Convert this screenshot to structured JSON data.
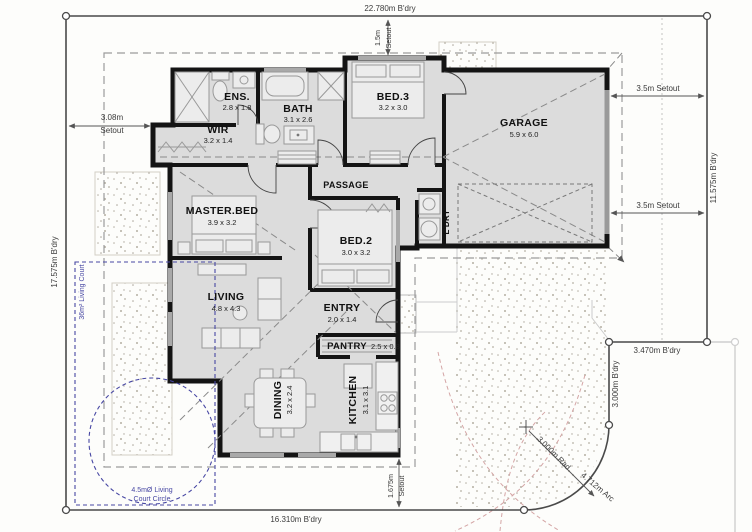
{
  "drawing": {
    "type": "residential floor plan / site plan"
  },
  "boundaries": {
    "top": "22.780m B'dry",
    "left": "17.575m B'dry",
    "right": "11.575m B'dry",
    "bottom": "16.310m B'dry",
    "corner_horizontal": "3.470m B'dry",
    "corner_vertical": "3.000m B'dry",
    "corner_radius": "3.000m Rad",
    "corner_arc": "4.712m Arc"
  },
  "setouts": {
    "north_value": "1.5m",
    "north_label": "Setout",
    "west_value": "3.08m",
    "west_label": "Setout",
    "east_top": "3.5m Setout",
    "east_bottom": "3.5m Setout",
    "south_value": "1.675m",
    "south_label": "Setout"
  },
  "living_court": {
    "area_label": "36m² Living Court",
    "circle_label_line1": "4.5mØ Living",
    "circle_label_line2": "Court Circle"
  },
  "rooms": {
    "ens": {
      "name": "ENS.",
      "dims": "2.8 x 1.8"
    },
    "wir": {
      "name": "WIR",
      "dims": "3.2 x 1.4"
    },
    "bath": {
      "name": "BATH",
      "dims": "3.1 x 2.6"
    },
    "bed3": {
      "name": "BED.3",
      "dims": "3.2 x 3.0"
    },
    "garage": {
      "name": "GARAGE",
      "dims": "5.9 x 6.0"
    },
    "passage": {
      "name": "PASSAGE"
    },
    "master": {
      "name": "MASTER.BED",
      "dims": "3.9 x 3.2"
    },
    "bed2": {
      "name": "BED.2",
      "dims": "3.0 x 3.2"
    },
    "ldry": {
      "name": "L'DRY"
    },
    "living": {
      "name": "LIVING",
      "dims": "4.8 x 4.3"
    },
    "entry": {
      "name": "ENTRY",
      "dims": "2.0 x 1.4"
    },
    "pantry": {
      "name": "PANTRY",
      "dims": "2.5 x 0.8"
    },
    "dining": {
      "name": "DINING",
      "dims": "3.2 x 2.4"
    },
    "kitchen": {
      "name": "KITCHEN",
      "dims": "3.1 x 3.1"
    }
  },
  "colors": {
    "wall": "#141414",
    "room_fill": "#dcdcdc",
    "boundary": "#4a4a4a",
    "living_court_blue": "#4747a3",
    "concrete_speckle": "#b5afa3",
    "turning_curve_pink": "#d4a5a5"
  }
}
